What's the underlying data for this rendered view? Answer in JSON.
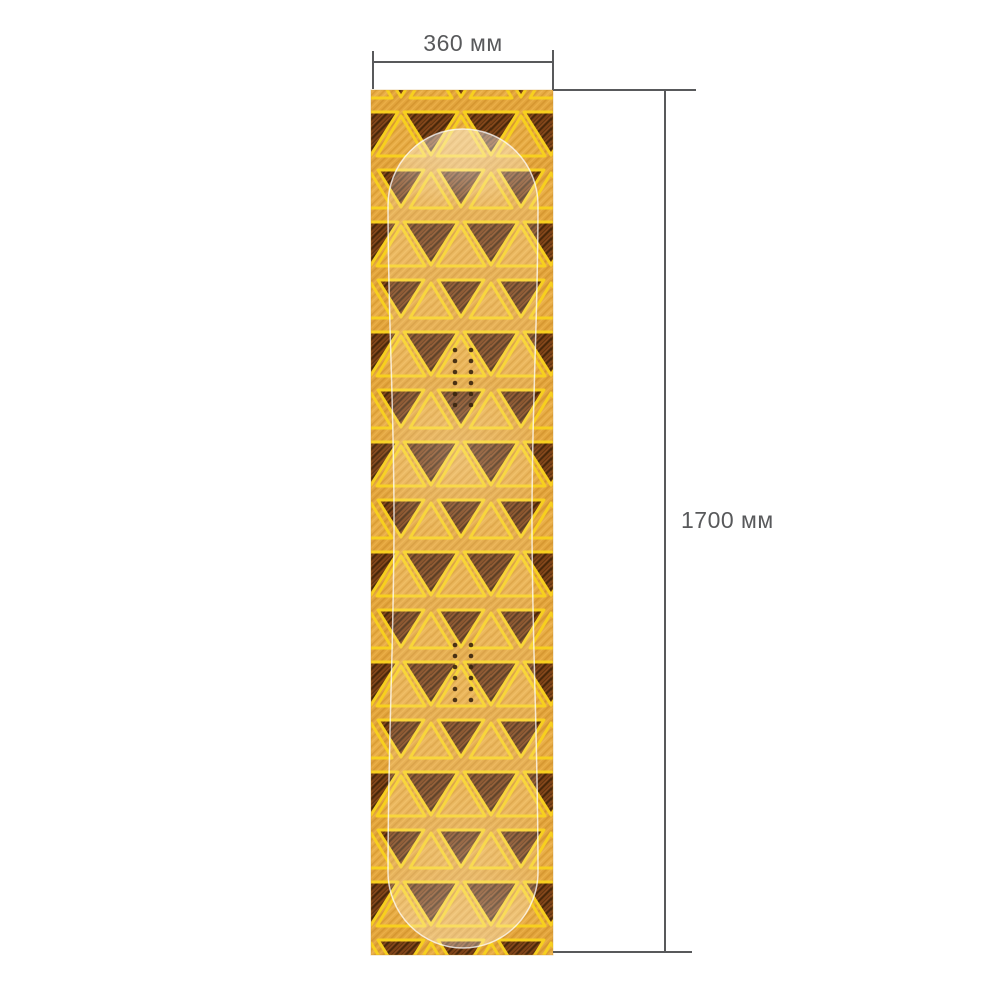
{
  "dimensions": {
    "width_label": "360 мм",
    "height_label": "1700 мм"
  },
  "colors": {
    "background": "#FFFFFF",
    "dimension_lines": "#58595B",
    "label_text": "#58595B",
    "pattern_amber": "#E2A43C",
    "pattern_amber_light": "#E8AC45",
    "pattern_yellow": "#F7D01E",
    "pattern_brown_dark": "#5A3210",
    "pattern_brown_rust": "#7E4216",
    "board_outline": "#FFFFFF"
  }
}
